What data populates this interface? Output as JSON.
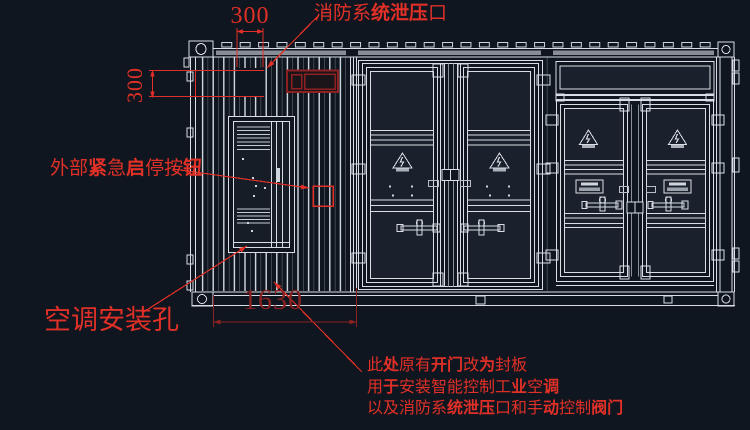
{
  "dimensions": {
    "top": "300",
    "left": "300",
    "bottom": "1630"
  },
  "labels": {
    "relief": {
      "segments": [
        {
          "t": "消防系",
          "b": false
        },
        {
          "t": "统泄压",
          "b": true
        },
        {
          "t": "口",
          "b": false
        }
      ]
    },
    "emergency": {
      "segments": [
        {
          "t": "外部",
          "b": false
        },
        {
          "t": "紧",
          "b": true
        },
        {
          "t": "急",
          "b": false
        },
        {
          "t": "启",
          "b": true
        },
        {
          "t": "停按",
          "b": false
        },
        {
          "t": "钮",
          "b": true
        }
      ]
    },
    "ac_hole": "空调安装孔",
    "note_lines": [
      {
        "segments": [
          {
            "t": "此",
            "b": false
          },
          {
            "t": "处",
            "b": true
          },
          {
            "t": "原有",
            "b": false
          },
          {
            "t": "开门",
            "b": true
          },
          {
            "t": "改",
            "b": false
          },
          {
            "t": "为",
            "b": true
          },
          {
            "t": "封板",
            "b": false
          }
        ]
      },
      {
        "segments": [
          {
            "t": "用",
            "b": false
          },
          {
            "t": "于",
            "b": true
          },
          {
            "t": "安装智能控制工",
            "b": false
          },
          {
            "t": "业",
            "b": true
          },
          {
            "t": "空",
            "b": false
          },
          {
            "t": "调",
            "b": true
          }
        ]
      },
      {
        "segments": [
          {
            "t": "以及消防系",
            "b": false
          },
          {
            "t": "统泄压",
            "b": true
          },
          {
            "t": "口和手",
            "b": false
          },
          {
            "t": "动",
            "b": true
          },
          {
            "t": "控制",
            "b": false
          },
          {
            "t": "阀门",
            "b": true
          }
        ]
      }
    ]
  },
  "colors": {
    "background": "#10161f",
    "line_bright": "#d9dee5",
    "line_dim": "#8a919b",
    "gray_fill": "#878e98",
    "red_bright": "#e03027",
    "red_dark": "#8c2121",
    "panel_fill": "#1a212c"
  }
}
